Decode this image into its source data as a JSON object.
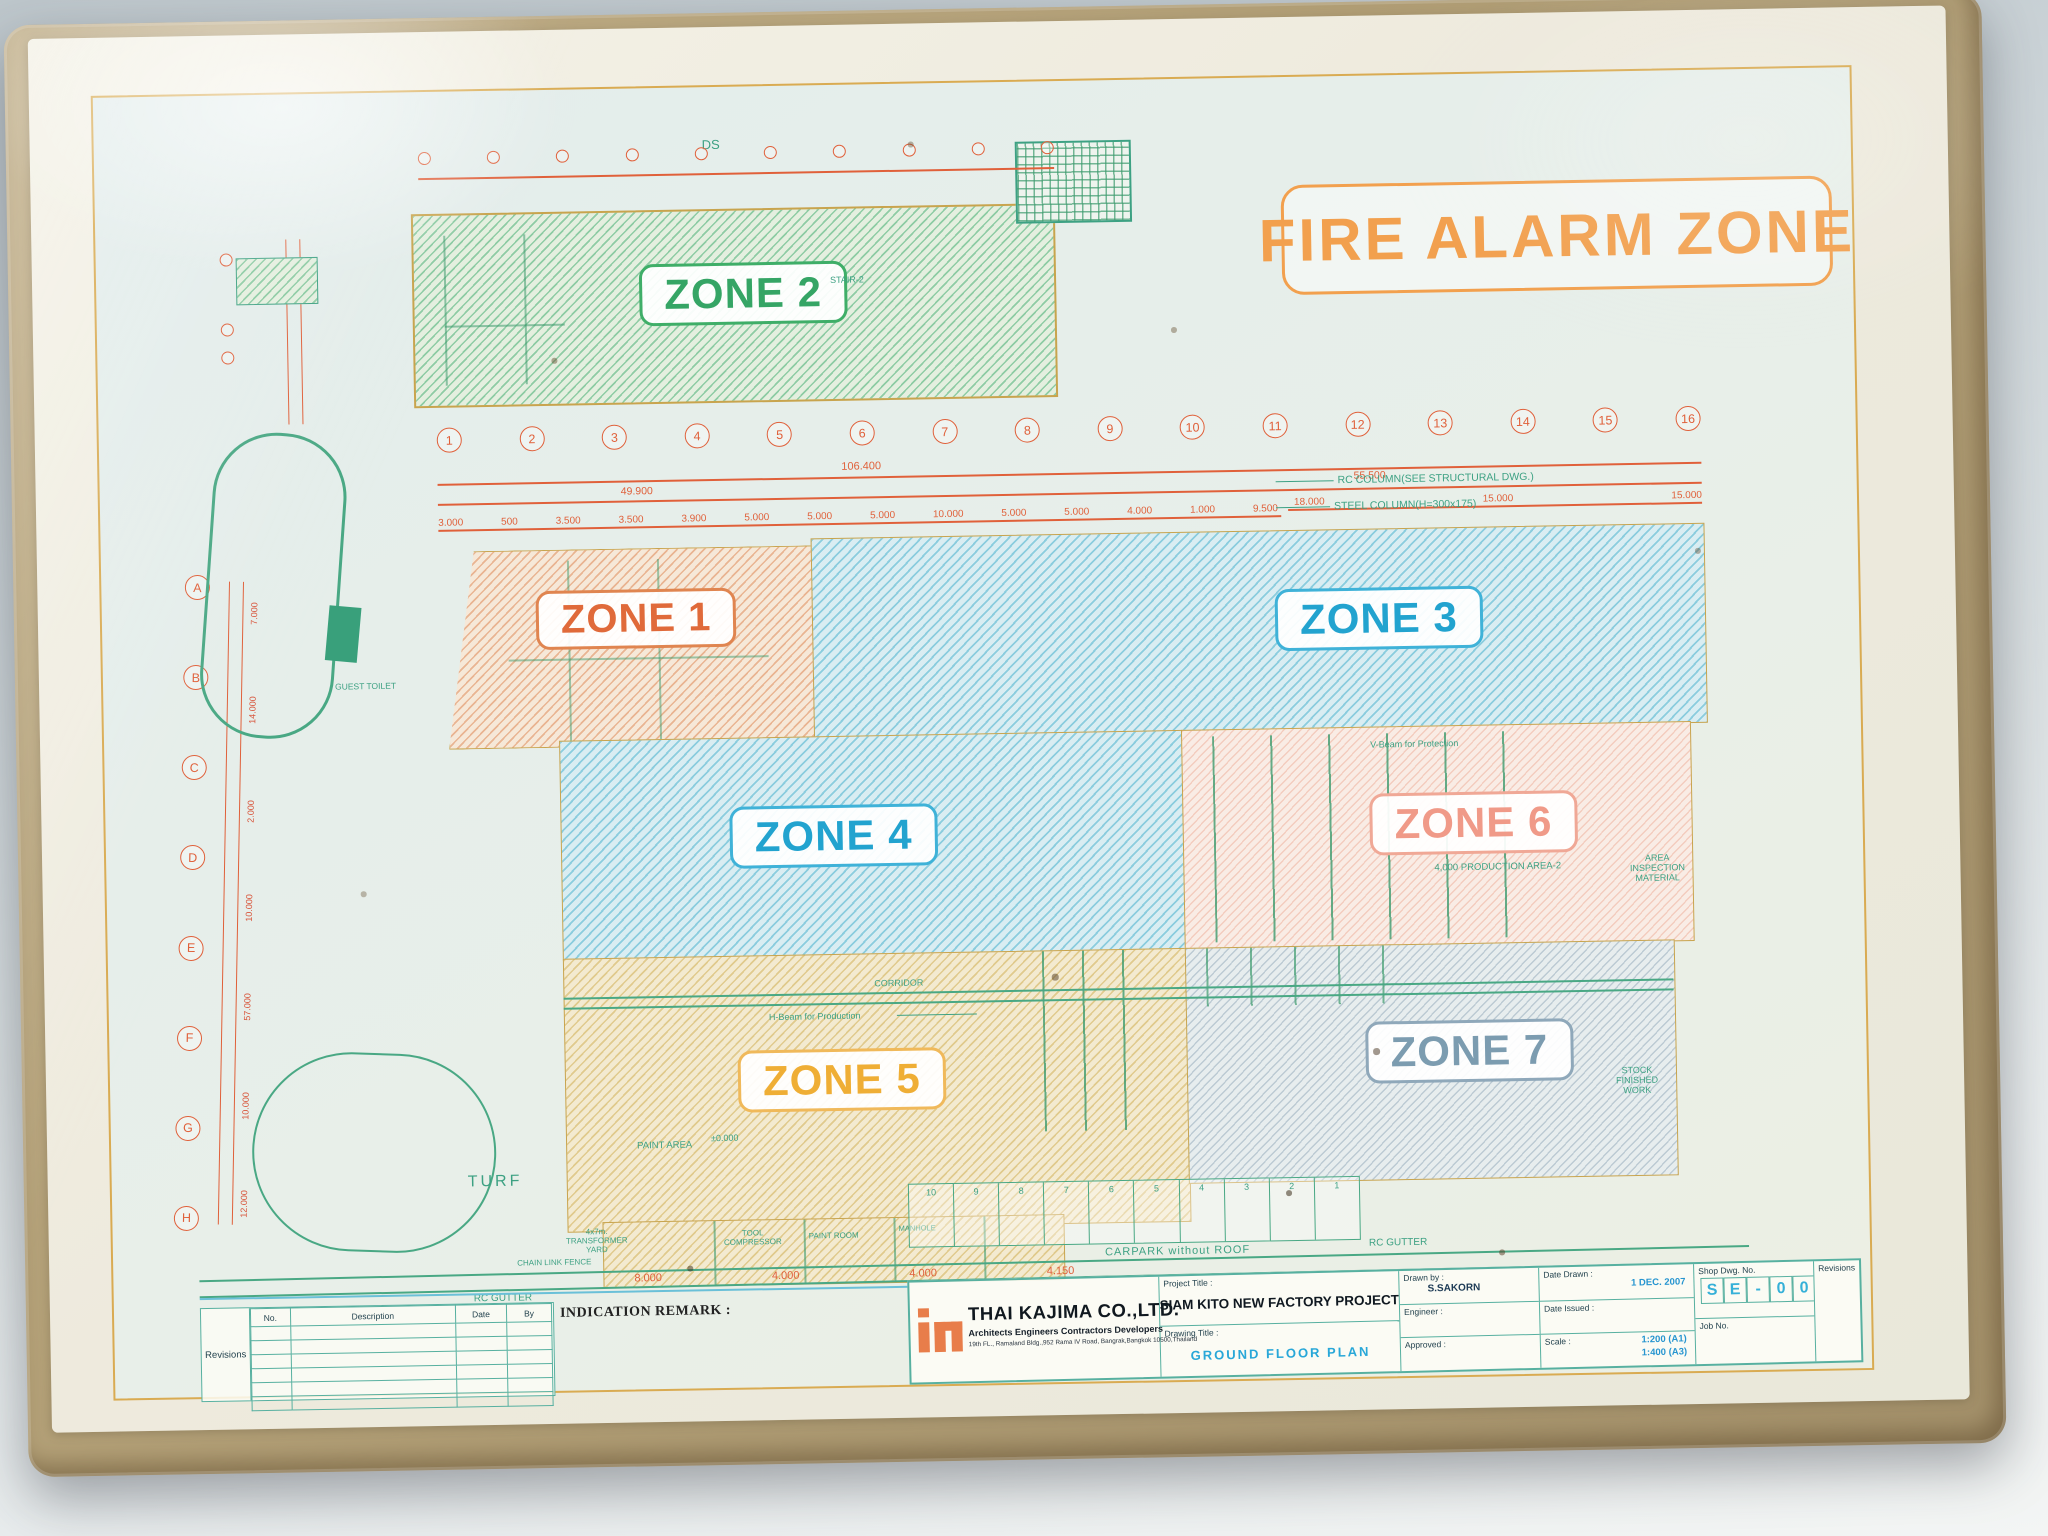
{
  "banner": {
    "title": "FIRE ALARM ZONE"
  },
  "zones": {
    "z1": {
      "label": "ZONE 1",
      "accent": "#e06a3a"
    },
    "z2": {
      "label": "ZONE 2",
      "accent": "#35a565"
    },
    "z3": {
      "label": "ZONE 3",
      "accent": "#22a3cf"
    },
    "z4": {
      "label": "ZONE 4",
      "accent": "#22a3cf"
    },
    "z5": {
      "label": "ZONE 5",
      "accent": "#efae35"
    },
    "z6": {
      "label": "ZONE 6",
      "accent": "#f09a88"
    },
    "z7": {
      "label": "ZONE 7",
      "accent": "#7c9cb0"
    }
  },
  "grid": {
    "columns": [
      "1",
      "2",
      "3",
      "4",
      "5",
      "6",
      "7",
      "8",
      "9",
      "10",
      "11",
      "12",
      "13",
      "14",
      "15",
      "16"
    ],
    "rows": [
      "A",
      "B",
      "C",
      "D",
      "E",
      "F",
      "G",
      "H"
    ],
    "overall_dim": "106.400",
    "left_span_dim": "49.900",
    "right_span_dim": "55.500",
    "top_dims": [
      "3.000",
      "500",
      "3.500",
      "3.500",
      "3.900",
      "5.000",
      "5.000",
      "5.000",
      "10.000",
      "5.000",
      "5.000",
      "4.000",
      "1.000",
      "9.500"
    ],
    "right_dims": [
      "18.000",
      "15.000",
      "15.000"
    ],
    "left_dims": [
      "7.000",
      "14.000",
      "2.000",
      "10.000",
      "57.000",
      "10.000",
      "12.000"
    ]
  },
  "notes": {
    "rc_column": "RC COLUMN(SEE STRUCTURAL DWG.)",
    "steel_column": "STEEL COLUMN(H=300x175)"
  },
  "plan_labels": {
    "ds": "DS",
    "stair2": "STAIR-2",
    "turf": "TURF",
    "guest_toilet": "GUEST TOILET",
    "corridor": "CORRIDOR",
    "h_beam": "H-Beam for Production",
    "v_beam": "V-Beam for Protection",
    "production_area": "4,000 PRODUCTION AREA-2",
    "inspection_area": "AREA INSPECTION MATERIAL",
    "stock_finished": "STOCK FINISHED WORK",
    "paint_area": "PAINT AREA",
    "level": "±0.000",
    "transformer_yard": "4x7m. TRANSFORMER YARD",
    "tool_compressor": "TOOL COMPRESSOR",
    "paint_room": "PAINT ROOM",
    "manhole": "MANHOLE",
    "chain_link_fence": "CHAIN LINK FENCE",
    "rc_gutter_left": "RC GUTTER",
    "rc_gutter_right": "RC GUTTER",
    "carpark": "CARPARK without ROOF"
  },
  "carpark_stalls": [
    "10",
    "9",
    "8",
    "7",
    "6",
    "5",
    "4",
    "3",
    "2",
    "1"
  ],
  "bottom_dims": [
    "8.000",
    "4.000",
    "4.000",
    "4.150"
  ],
  "revision_table": {
    "section_label": "Revisions",
    "headers": [
      "No.",
      "Description",
      "Date",
      "By"
    ],
    "remark": "INDICATION REMARK :"
  },
  "title_block": {
    "company": "THAI KAJIMA CO.,LTD.",
    "tagline": "Architects Engineers Contractors Developers",
    "address": "19th FL., Ramaland Bldg.,952 Rama IV Road, Bangrak,Bangkok 10500,Thailand",
    "project_title_label": "Project Title :",
    "project_title": "SIAM KITO NEW FACTORY PROJECT",
    "drawing_title_label": "Drawing Title :",
    "drawing_title": "GROUND FLOOR PLAN",
    "drawn_by_label": "Drawn by :",
    "drawn_by": "S.SAKORN",
    "engineer_label": "Engineer :",
    "approved_label": "Approved :",
    "date_drawn_label": "Date Drawn :",
    "date_drawn": "1 DEC. 2007",
    "date_issued_label": "Date Issued :",
    "scale_label": "Scale :",
    "scale_a1": "1:200 (A1)",
    "scale_a3": "1:400 (A3)",
    "shop_dwg_label": "Shop Dwg. No.",
    "shop_dwg_cells": [
      "S",
      "E",
      "-",
      "0",
      "0"
    ],
    "job_no_label": "Job No.",
    "revisions_label": "Revisions"
  },
  "colors": {
    "banner_orange": "#f2a04e",
    "drawing_green": "#49a884",
    "dimension_red": "#e0603a",
    "table_line_teal": "#57b0a0",
    "sleeve_tan": "#b3a077"
  }
}
